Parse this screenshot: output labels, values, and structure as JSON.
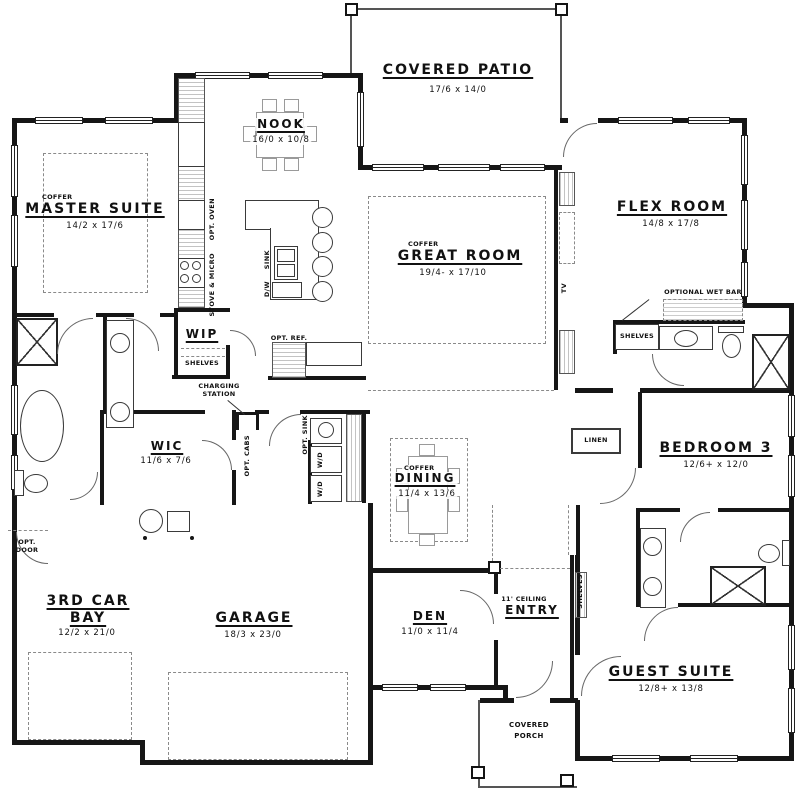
{
  "plan": {
    "rooms": {
      "covered_patio": {
        "name": "COVERED PATIO",
        "dims": "17/6 x 14/0"
      },
      "nook": {
        "name": "NOOK",
        "dims": "16/0 x 10/8"
      },
      "master_suite": {
        "coffer": "COFFER",
        "name": "MASTER SUITE",
        "dims": "14/2 x 17/6"
      },
      "great_room": {
        "coffer": "COFFER",
        "name": "GREAT ROOM",
        "dims": "19/4- x 17/10"
      },
      "flex_room": {
        "name": "FLEX ROOM",
        "dims": "14/8 x 17/8"
      },
      "wip": {
        "name": "WIP",
        "shelves": "SHELVES"
      },
      "wic": {
        "name": "WIC",
        "dims": "11/6 x 7/6"
      },
      "dining": {
        "coffer": "COFFER",
        "name": "DINING",
        "dims": "11/4 x 13/6"
      },
      "bedroom3": {
        "name": "BEDROOM 3",
        "dims": "12/6+ x 12/0"
      },
      "third_car_bay": {
        "line1": "3RD CAR",
        "line2": "BAY",
        "dims": "12/2 x 21/0"
      },
      "garage": {
        "name": "GARAGE",
        "dims": "18/3 x 23/0"
      },
      "den": {
        "name": "DEN",
        "dims": "11/0 x 11/4"
      },
      "entry": {
        "note": "11' CEILING",
        "name": "ENTRY"
      },
      "guest_suite": {
        "name": "GUEST SUITE",
        "dims": "12/8+ x 13/8"
      },
      "covered_porch": {
        "line1": "COVERED",
        "line2": "PORCH"
      }
    },
    "labels": {
      "optional_wet_bar": "OPTIONAL WET BAR",
      "shelves": "SHELVES",
      "linen": "LINEN",
      "charging_line1": "CHARGING",
      "charging_line2": "STATION",
      "opt_ref": "OPT. REF.",
      "opt_oven": "OPT. OVEN",
      "stove_micro": "STOVE & MICRO",
      "sink": "SINK",
      "dw": "D/W",
      "opt_cabs": "OPT. CABS",
      "opt_sink": "OPT. SINK",
      "wd": "W/D",
      "opt_door_line1": "OPT.",
      "opt_door_line2": "DOOR",
      "tv": "TV"
    }
  }
}
